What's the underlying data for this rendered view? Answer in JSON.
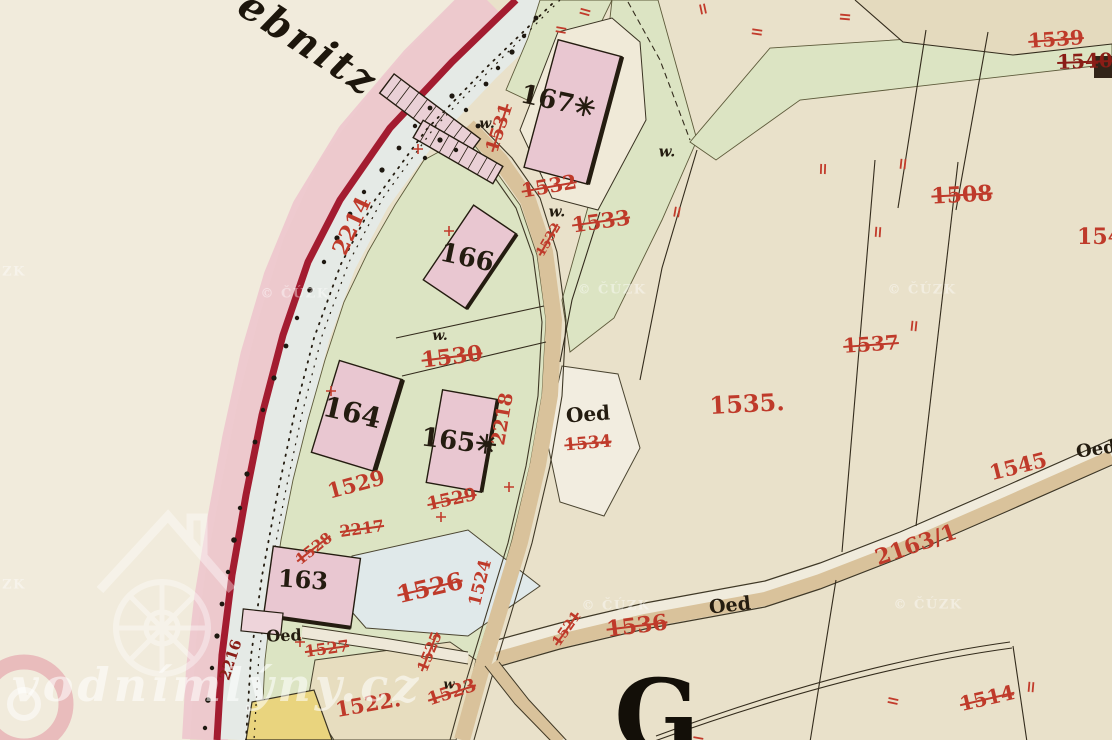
{
  "map": {
    "river_label": {
      "t": "ebnitz",
      "x": 308,
      "y": 44,
      "r": 33,
      "s": 40
    },
    "settlement_initial": {
      "t": "G",
      "x": 657,
      "y": 716,
      "r": 0,
      "s": 100
    },
    "parcel_numbers": [
      {
        "t": "2214",
        "x": 352,
        "y": 226,
        "r": -65,
        "s": 22
      },
      {
        "t": "1531",
        "x": 500,
        "y": 128,
        "r": -72,
        "s": 18,
        "st": 1
      },
      {
        "t": "1532",
        "x": 549,
        "y": 186,
        "r": -10,
        "s": 20,
        "st": 1
      },
      {
        "t": "1532",
        "x": 549,
        "y": 240,
        "r": -60,
        "s": 13,
        "st": 1
      },
      {
        "t": "1533",
        "x": 601,
        "y": 221,
        "r": -8,
        "s": 21,
        "st": 1
      },
      {
        "t": "1530",
        "x": 452,
        "y": 357,
        "r": -7,
        "s": 22,
        "st": 1
      },
      {
        "t": "2218",
        "x": 503,
        "y": 419,
        "r": -80,
        "s": 19
      },
      {
        "t": "1529",
        "x": 356,
        "y": 484,
        "r": -15,
        "s": 21
      },
      {
        "t": "1529",
        "x": 452,
        "y": 500,
        "r": -12,
        "s": 18,
        "st": 1
      },
      {
        "t": "1534",
        "x": 588,
        "y": 444,
        "r": -5,
        "s": 17,
        "st": 1
      },
      {
        "t": "1535.",
        "x": 747,
        "y": 404,
        "r": -3,
        "s": 24
      },
      {
        "t": "2217",
        "x": 362,
        "y": 529,
        "r": -8,
        "s": 16,
        "st": 1
      },
      {
        "t": "1528",
        "x": 314,
        "y": 549,
        "r": -38,
        "s": 15,
        "st": 1
      },
      {
        "t": "1526",
        "x": 430,
        "y": 588,
        "r": -13,
        "s": 24,
        "st": 1
      },
      {
        "t": "1527",
        "x": 327,
        "y": 649,
        "r": -8,
        "s": 16,
        "st": 1
      },
      {
        "t": "1525",
        "x": 430,
        "y": 652,
        "r": -68,
        "s": 15,
        "st": 1
      },
      {
        "t": "1524",
        "x": 481,
        "y": 583,
        "r": -76,
        "s": 17
      },
      {
        "t": "1521",
        "x": 567,
        "y": 629,
        "r": -55,
        "s": 14,
        "st": 1
      },
      {
        "t": "1522.",
        "x": 368,
        "y": 704,
        "r": -10,
        "s": 21
      },
      {
        "t": "1523",
        "x": 452,
        "y": 693,
        "r": -18,
        "s": 18,
        "st": 1
      },
      {
        "t": "1536",
        "x": 637,
        "y": 626,
        "r": -7,
        "s": 22,
        "st": 1
      },
      {
        "t": "1545",
        "x": 1018,
        "y": 466,
        "r": -14,
        "s": 21
      },
      {
        "t": "2163/1",
        "x": 916,
        "y": 545,
        "r": -19,
        "s": 22
      },
      {
        "t": "1537",
        "x": 871,
        "y": 344,
        "r": -4,
        "s": 20,
        "st": 1
      },
      {
        "t": "1508",
        "x": 962,
        "y": 195,
        "r": -3,
        "s": 22,
        "st": 1
      },
      {
        "t": "154",
        "x": 1100,
        "y": 237,
        "r": 0,
        "s": 22
      },
      {
        "t": "1539",
        "x": 1056,
        "y": 39,
        "r": -4,
        "s": 20,
        "st": 1
      },
      {
        "t": "1540",
        "x": 1085,
        "y": 61,
        "r": -2,
        "s": 20,
        "st": 1,
        "dk": 1
      },
      {
        "t": "1514",
        "x": 987,
        "y": 698,
        "r": -13,
        "s": 20,
        "st": 1
      },
      {
        "t": "2216",
        "x": 231,
        "y": 660,
        "r": -72,
        "s": 15,
        "dk": 1
      }
    ],
    "building_numbers": [
      {
        "t": "167",
        "x": 558,
        "y": 102,
        "r": 12,
        "s": 26,
        "star": 1
      },
      {
        "t": "166",
        "x": 467,
        "y": 258,
        "r": 12,
        "s": 26
      },
      {
        "t": "164",
        "x": 352,
        "y": 413,
        "r": 13,
        "s": 28
      },
      {
        "t": "165",
        "x": 459,
        "y": 442,
        "r": 7,
        "s": 26,
        "star": 1
      },
      {
        "t": "163",
        "x": 303,
        "y": 580,
        "r": 4,
        "s": 24
      }
    ],
    "land_use_labels": [
      {
        "t": "Oed",
        "x": 588,
        "y": 414,
        "r": -4,
        "s": 20
      },
      {
        "t": "Oed",
        "x": 284,
        "y": 636,
        "r": -2,
        "s": 16
      },
      {
        "t": "Oed",
        "x": 730,
        "y": 606,
        "r": -6,
        "s": 19
      },
      {
        "t": "Oed",
        "x": 1096,
        "y": 450,
        "r": -8,
        "s": 18
      }
    ],
    "meadow_marks": [
      {
        "t": "w.",
        "x": 487,
        "y": 124,
        "r": 0,
        "s": 14
      },
      {
        "t": "w.",
        "x": 440,
        "y": 336,
        "r": 0,
        "s": 14
      },
      {
        "t": "w.",
        "x": 557,
        "y": 212,
        "r": 0,
        "s": 15
      },
      {
        "t": "w.",
        "x": 667,
        "y": 152,
        "r": 0,
        "s": 15
      },
      {
        "t": "w",
        "x": 449,
        "y": 685,
        "r": 0,
        "s": 13
      }
    ],
    "watermarks": {
      "site": "vodnímlýny.cz",
      "agency": "© ČÚZK",
      "agency_positions": [
        {
          "x": 295,
          "y": 294
        },
        {
          "x": 612,
          "y": 290
        },
        {
          "x": 922,
          "y": 290
        },
        {
          "x": 616,
          "y": 606
        },
        {
          "x": 928,
          "y": 605
        },
        {
          "x": 14,
          "y": 272,
          "t": "ZK"
        },
        {
          "x": 14,
          "y": 585,
          "t": "ZK"
        }
      ]
    },
    "colors": {
      "paper": "#e9e1ca",
      "paper_light": "#f1ebdc",
      "pink_band": "#edc7cd",
      "road_red": "#a31c30",
      "stream": "#e5eae6",
      "meadow": "#dce4c3",
      "road_tan": "#d9c29b",
      "building_pink": "#e9c7d1",
      "pond": "#e0e9ea",
      "field_yellow": "#e9d47e",
      "label_red": "#bf3a2a",
      "label_dark_red": "#8a1d16",
      "ink": "#241c10",
      "watermark_white": "rgba(255,255,255,0.5)"
    }
  }
}
